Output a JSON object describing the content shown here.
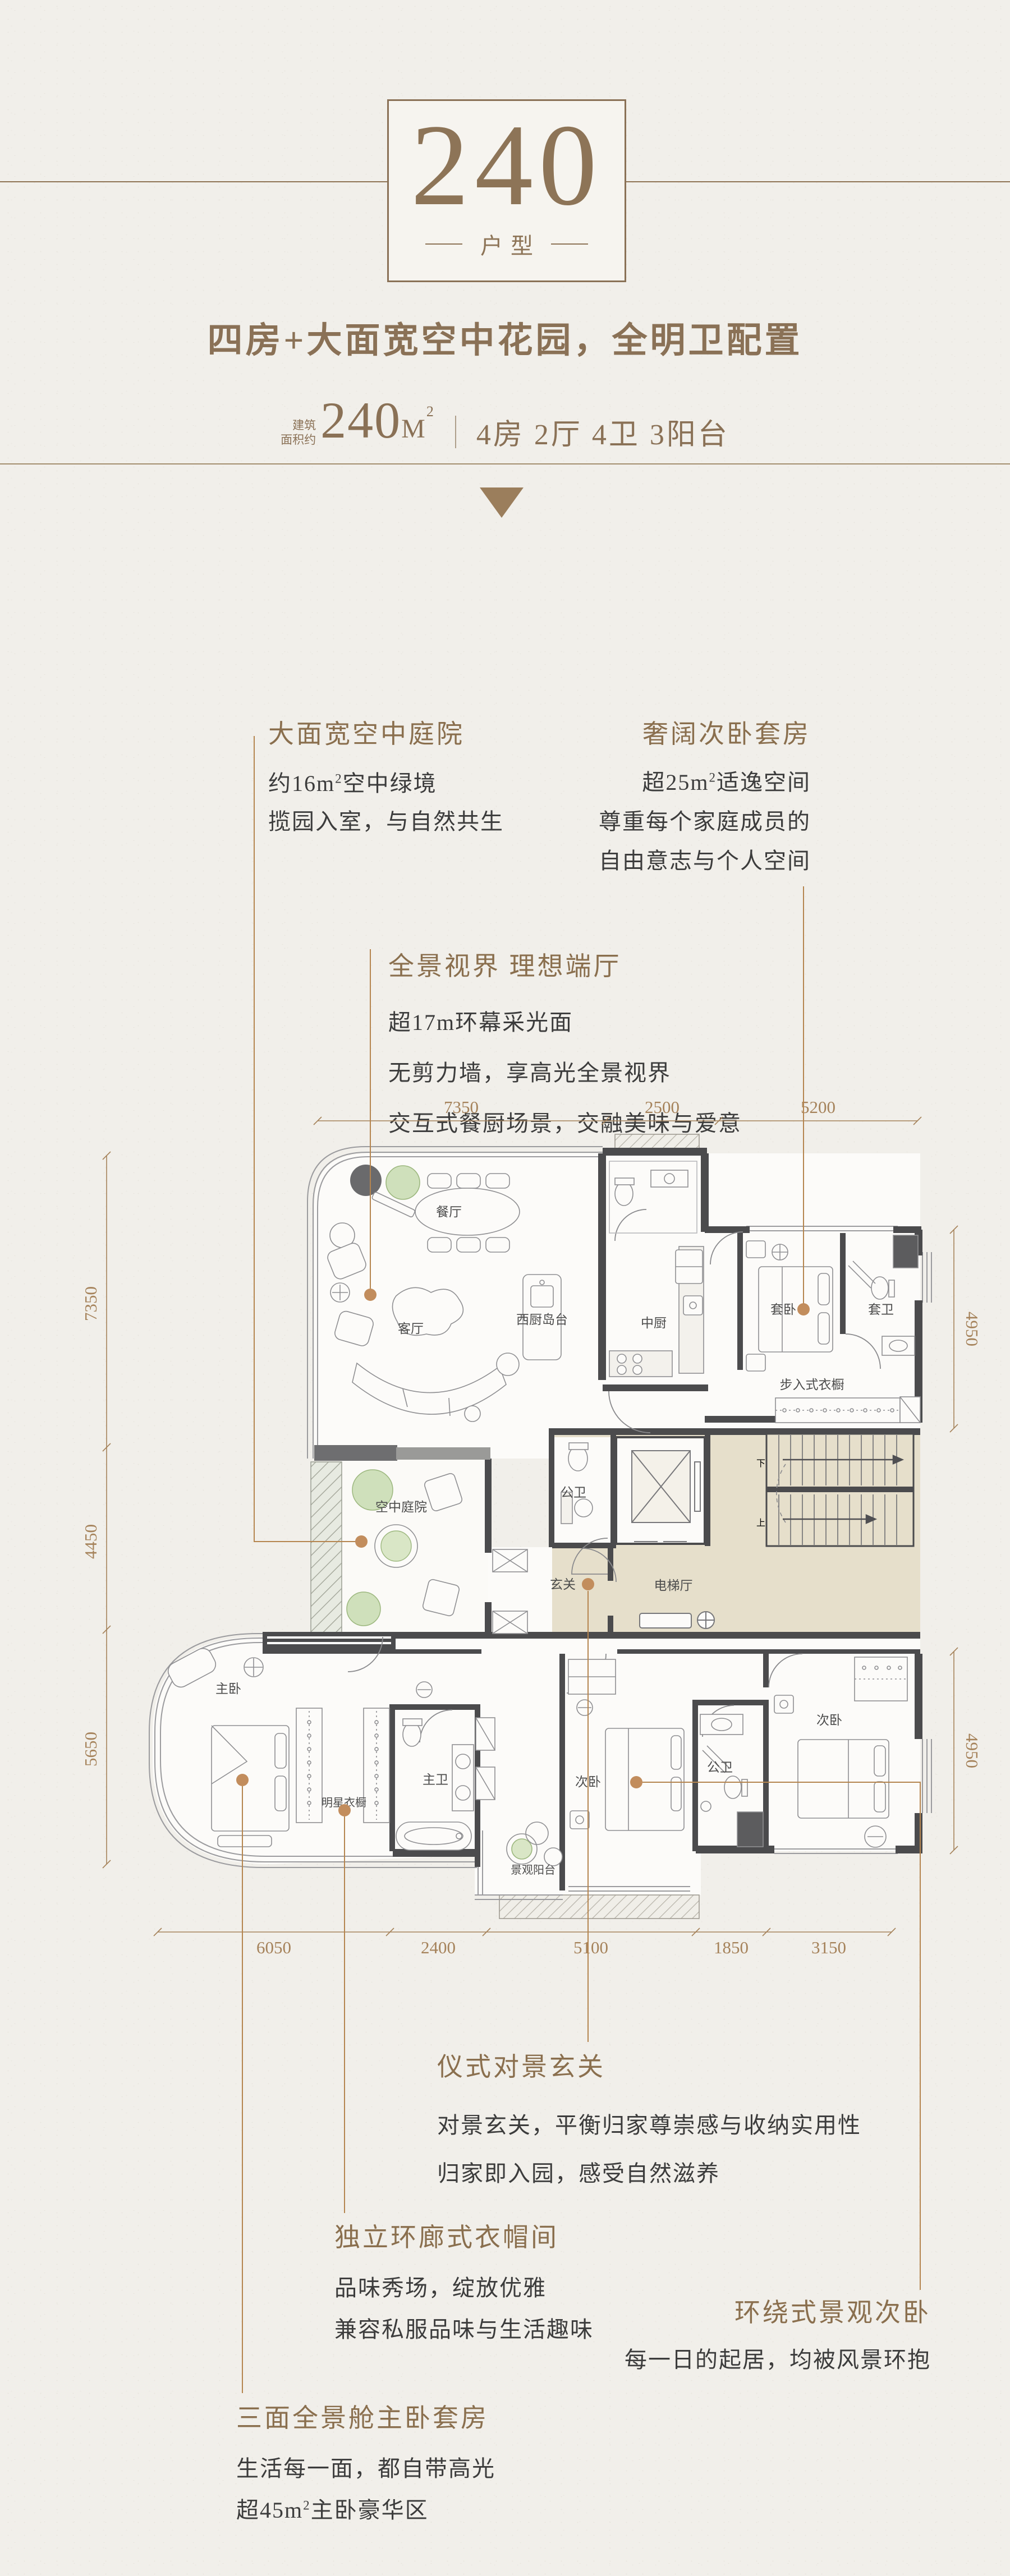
{
  "header": {
    "type_number": "240",
    "type_label": "户型",
    "headline": "四房+大面宽空中花园，全明卫配置",
    "area_prefix_line1": "建筑",
    "area_prefix_line2": "面积约",
    "area_value": "240",
    "area_unit": "M",
    "area_sup": "2",
    "specs": "4房 2厅 4卫 3阳台"
  },
  "annotations": [
    {
      "title": "大面宽空中庭院",
      "area_pre": "约16",
      "area_unit": "m",
      "area_sup": "2",
      "area_post": "空中绿境",
      "line2": "揽园入室，与自然共生"
    },
    {
      "title": "奢阔次卧套房",
      "area_pre": "超25",
      "area_unit": "m",
      "area_sup": "2",
      "area_post": "适逸空间",
      "line2": "尊重每个家庭成员的",
      "line3": "自由意志与个人空间"
    },
    {
      "title": "全景视界 理想端厅",
      "line1": "超17m环幕采光面",
      "line2": "无剪力墙，享高光全景视界",
      "line3": "交互式餐厨场景，交融美味与爱意"
    },
    {
      "title": "仪式对景玄关",
      "line1": "对景玄关，平衡归家尊崇感与收纳实用性",
      "line2": "归家即入园，感受自然滋养"
    },
    {
      "title": "独立环廊式衣帽间",
      "line1": "品味秀场，绽放优雅",
      "line2": "兼容私服品味与生活趣味"
    },
    {
      "title": "环绕式景观次卧",
      "line1": "每一日的起居，均被风景环抱"
    },
    {
      "title": "三面全景舱主卧套房",
      "line1": "生活每一面，都自带高光",
      "area_pre": "超45",
      "area_unit": "m",
      "area_sup": "2",
      "area_post": "主卧豪华区"
    }
  ],
  "plan": {
    "labels": {
      "dining": "餐厅",
      "living": "客厅",
      "island": "西厨岛台",
      "kitchen": "中厨",
      "suite_bed": "套卧",
      "suite_bath": "套卫",
      "walkin": "步入式衣橱",
      "courtyard": "空中庭院",
      "core_bath": "公卫",
      "lift_hall": "电梯厅",
      "foyer": "玄关",
      "stair_down": "下",
      "stair_up": "上",
      "master": "主卧",
      "star_closet": "明星衣橱",
      "master_bath": "主卫",
      "view_balcony": "景观阳台",
      "bed2": "次卧",
      "shared_bath": "公卫",
      "bed3": "次卧"
    },
    "dims": {
      "top": [
        "7350",
        "2500",
        "5200"
      ],
      "left": [
        "7350",
        "4450",
        "5650"
      ],
      "right": [
        "4950",
        "4950"
      ],
      "bottom": [
        "6050",
        "2400",
        "5100",
        "1850",
        "3150"
      ]
    }
  }
}
